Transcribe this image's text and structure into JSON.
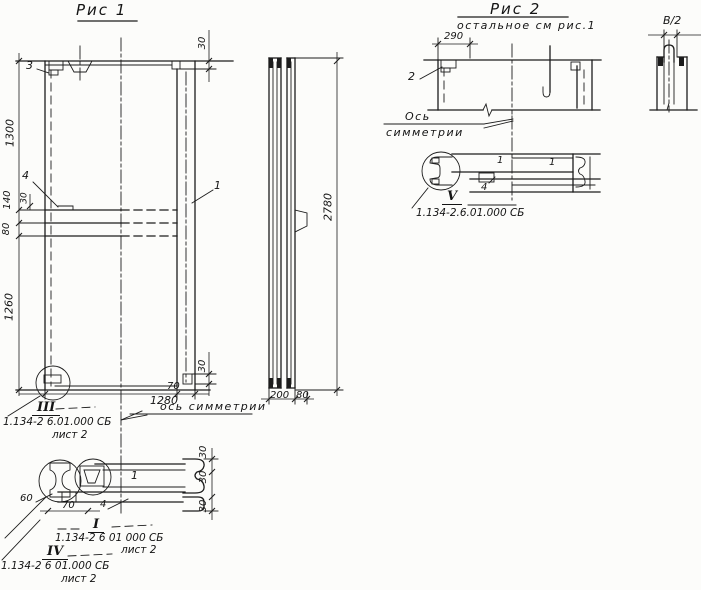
{
  "fig1": {
    "title": "Рис 1",
    "label_1": "1",
    "label_3": "3",
    "label_4": "4",
    "dim_1300": "1300",
    "dim_140": "140",
    "dim_30_notch": "30",
    "dim_80": "80",
    "dim_1260": "1260",
    "dim_30_top_right": "30",
    "dim_30_bottom_right": "30",
    "dim_1280": "1280",
    "dim_70": "70",
    "axis_note": "ось симметрии",
    "callout_iii_roman": "III",
    "callout_iii_doc": "1.134-2 6.01.000 СБ",
    "callout_iii_sheet": "лист 2"
  },
  "side_view": {
    "dim_2780": "2780",
    "dim_200": "200",
    "dim_80": "80"
  },
  "section_i": {
    "dim_60": "60",
    "dim_70": "70",
    "label_4": "4",
    "label_1": "1",
    "dim_30_a": "30",
    "dim_30_b": "30",
    "dim_30_c": "30",
    "callout_i_roman": "I",
    "callout_i_doc": "1.134-2 6 01 000 СБ",
    "callout_i_sheet": "лист 2",
    "callout_iv_roman": "IV",
    "callout_iv_doc": "1.134-2 6 01.000 СБ",
    "callout_iv_sheet": "лист 2"
  },
  "fig2": {
    "title": "Рис 2",
    "subtitle": "остальное см рис.1",
    "dim_290": "290",
    "label_2": "2",
    "axis_word_1": "Ось",
    "axis_word_2": "симметрии",
    "label_1_left": "1",
    "label_1_right": "1",
    "label_4": "4",
    "callout_v_roman": "V",
    "callout_v_doc": "1.134-2.6.01.000 СБ"
  },
  "detail_b2": {
    "label": "В/2"
  }
}
